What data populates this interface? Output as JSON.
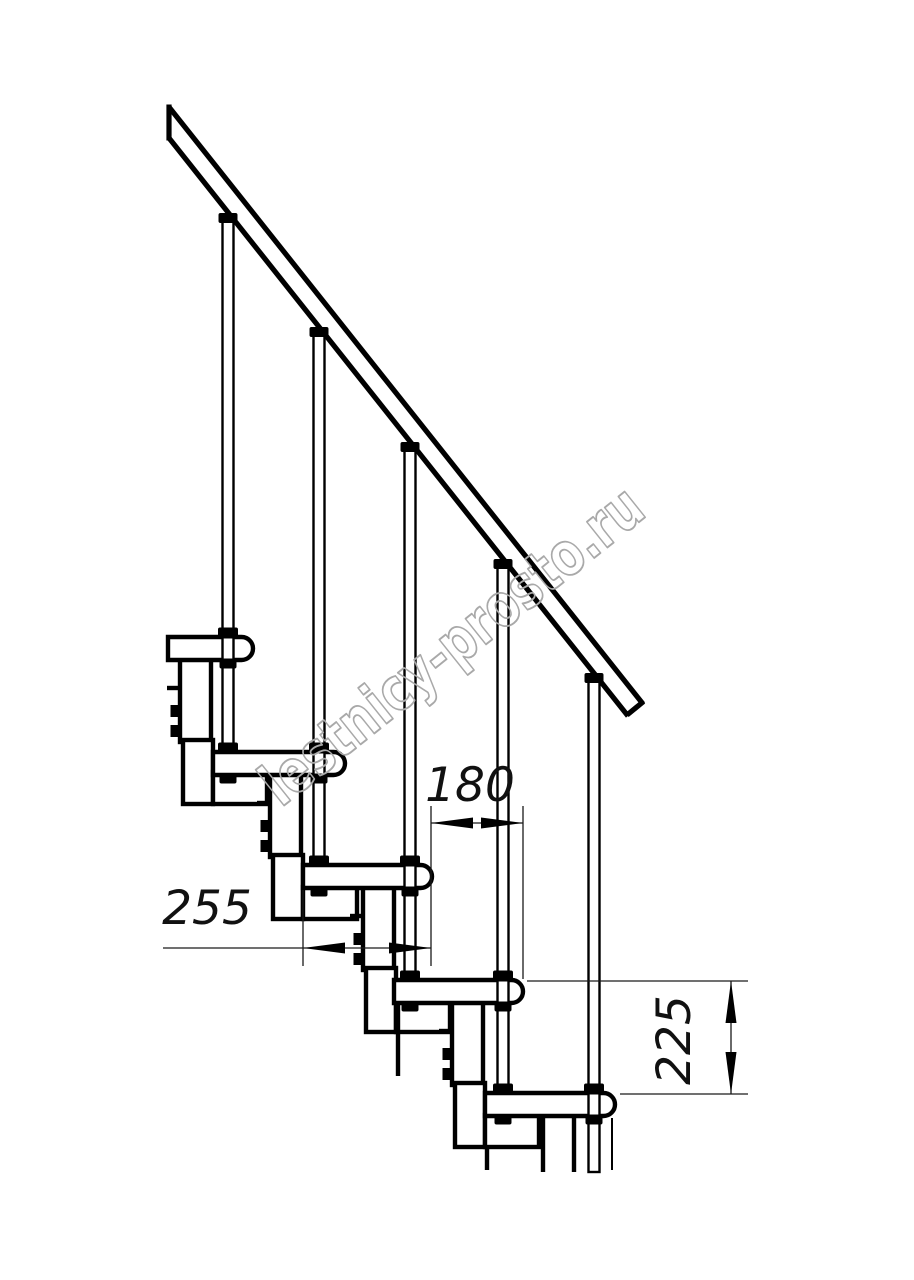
{
  "watermark": {
    "text": "lestnicy-prosto.ru",
    "color": "#a9a9a9"
  },
  "dimensions": {
    "step_nose_offset": {
      "value": "180"
    },
    "tread_depth": {
      "value": "255"
    },
    "riser_height": {
      "value": "225"
    }
  },
  "colors": {
    "line": "#000000",
    "dim_line": "#1a1a1a",
    "background": "#ffffff"
  }
}
